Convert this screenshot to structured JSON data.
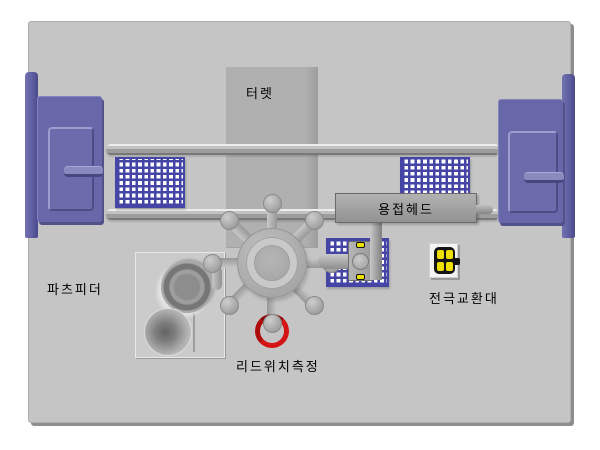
{
  "diagram": {
    "title": "machine-layout-top-view",
    "labels": {
      "turret": "터렛",
      "welding_head": "용접헤드",
      "parts_feeder": "파츠피더",
      "electrode_exchange": "전극교환대",
      "lead_position_measure": "리드위치측정"
    },
    "colors": {
      "panel_bg": "#C5C5C5",
      "machine_gray": "#ADADAD",
      "cabinet_purple": "#6767A9",
      "cabinet_bar_purple": "#5E5EA0",
      "tray_blue": "#4545A6",
      "tray_cell_white": "#FFFFFF",
      "highlight_red": "#D41414",
      "indicator_yellow": "#EDE000",
      "label_text": "#000000"
    }
  }
}
